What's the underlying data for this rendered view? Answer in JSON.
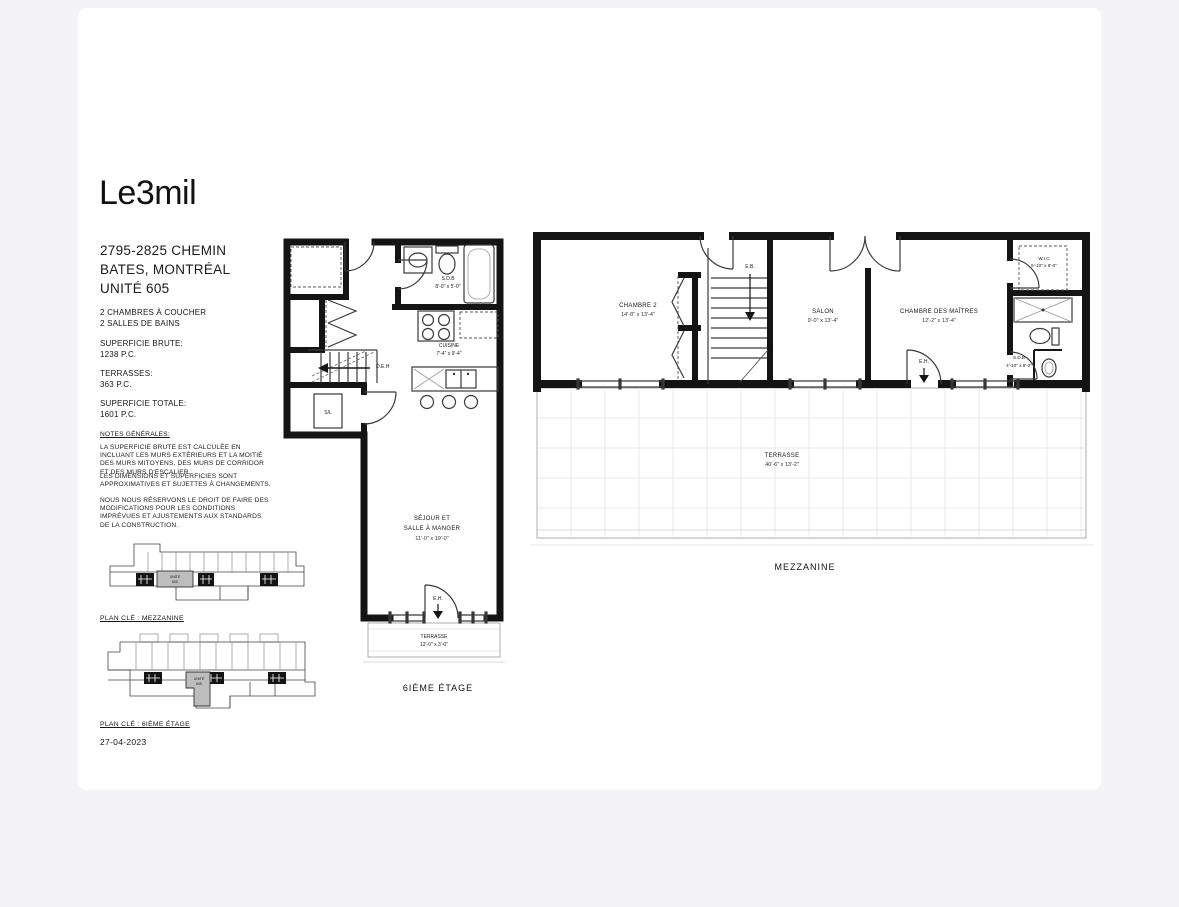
{
  "branding": {
    "logo": "Le3mil"
  },
  "project": {
    "address_line1": "2795-2825 CHEMIN",
    "address_line2": "BATES, MONTRÉAL",
    "address_line3": "UNITÉ 605",
    "feature_line1": "2 CHAMBRES À COUCHER",
    "feature_line2": "2 SALLES DE BAINS",
    "superficie_brute_label": "SUPERFICIE BRUTE:",
    "superficie_brute_value": "1238 P.C.",
    "terrasses_label": "TERRASSES:",
    "terrasses_value": "363 P.C.",
    "superficie_totale_label": "SUPERFICIE TOTALE:",
    "superficie_totale_value": "1601 P.C."
  },
  "notes": {
    "title": "NOTES GÉNÉRALES:",
    "p1": "LA SUPERFICIE BRUTE EST CALCULÉE EN INCLUANT LES MURS EXTÉRIEURS ET LA MOITIÉ DES MURS MITOYENS, DES MURS DE CORRIDOR ET DES MURS D'ESCALIER.",
    "p2": "LES DIMENSIONS ET SUPERFICIES SONT APPROXIMATIVES ET SUJETTES À CHANGEMENTS.",
    "p3": "NOUS NOUS RÉSERVONS LE DROIT DE FAIRE DES MODIFICATIONS POUR LES CONDITIONS IMPRÉVUES ET AJUSTEMENTS AUX STANDARDS DE LA CONSTRUCTION."
  },
  "key_plans": {
    "mezzanine_label": "PLAN CLÉ : MEZZANINE",
    "sixth_label": "PLAN CLÉ : 6IÈME ÉTAGE",
    "unit_line1": "UNITÉ",
    "unit_line2": "605"
  },
  "plan6": {
    "title": "6IÈME ÉTAGE",
    "sdb_name": "S.D.B",
    "sdb_dims": "8'-0\" x 5'-0\"",
    "cuisine_name": "CUISINE",
    "cuisine_dims": "7'-4\" x 9'-4\"",
    "sejour_line1": "SÉJOUR ET",
    "sejour_line2": "SALLE À MANGER",
    "sejour_dims": "11'-0\" x 19'-0\"",
    "terrasse_name": "TERRASSE",
    "terrasse_dims": "12'-0\" x 3'-0\"",
    "sl_label": "S/L",
    "deh_label": "D.E.H",
    "eh_label": "E.H."
  },
  "mezz": {
    "title": "MEZZANINE",
    "chambre2_name": "CHAMBRE 2",
    "chambre2_dims": "14'-8\" x 13'-4\"",
    "salon_name": "SALON",
    "salon_dims": "9'-0\" x 13'-4\"",
    "maitres_name": "CHAMBRE DES MAÎTRES",
    "maitres_dims": "12'-2\" x 13'-4\"",
    "wic_name": "W.I.C",
    "wic_dims": "5'-10\" x 6'-0\"",
    "sdb_name": "S.D.B",
    "sdb_dims": "4'-10\" x 8'-0\"",
    "terrasse_name": "TERRASSE",
    "terrasse_dims": "40'-6\" x 13'-2\"",
    "eb_label": "E.B.",
    "eh_label": "E.H."
  },
  "footer": {
    "date": "27-04-2023"
  },
  "colors": {
    "page_bg": "#f4f4f6",
    "sheet_bg": "#ffffff",
    "ink": "#161616",
    "highlight": "#bdbdbd"
  }
}
